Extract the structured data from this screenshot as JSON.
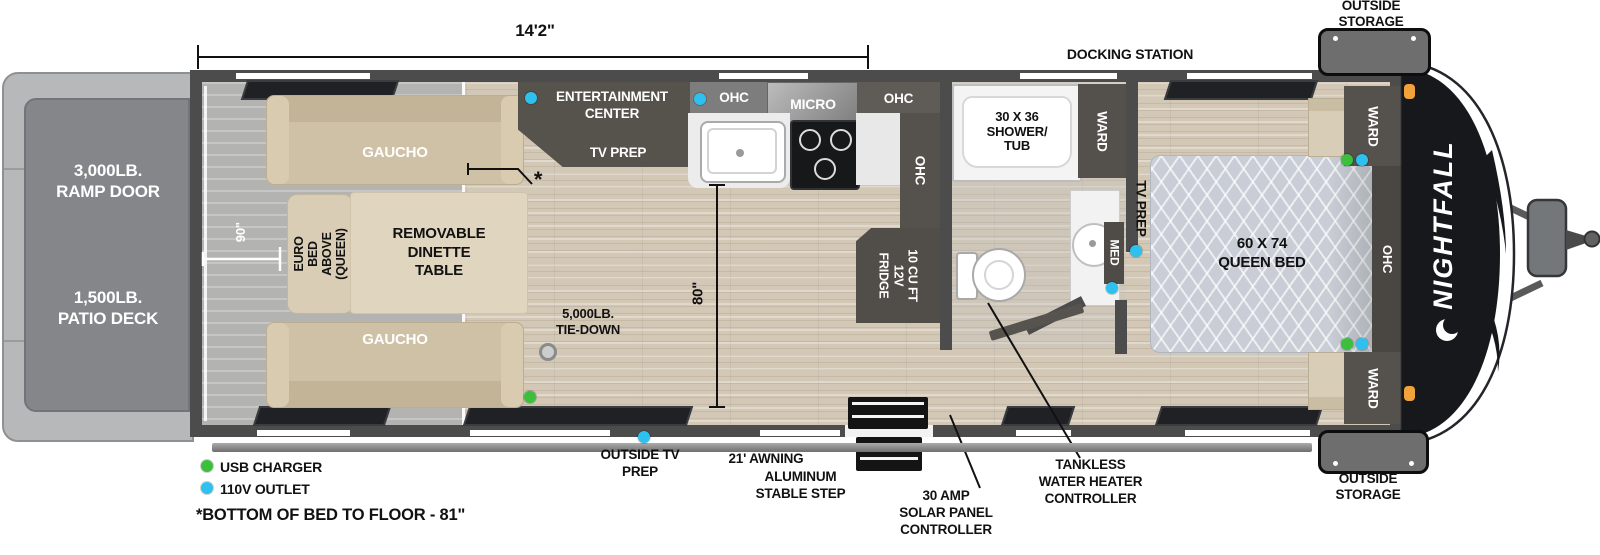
{
  "colors": {
    "accent_green": "#3cbf3c",
    "accent_blue": "#2ec1f0",
    "wall": "#4c4c4c",
    "wood_floor": "#d3c8b6",
    "cabinet_dark": "#55514c"
  },
  "dims": {
    "length": "14'2\"",
    "garage_width": "90\"",
    "kitchen_height": "80\"",
    "asterisk_mark": "*"
  },
  "exterior": {
    "brand": "NIGHTFALL",
    "docking_station": "DOCKING STATION",
    "outside_storage_top": "OUTSIDE\nSTORAGE",
    "outside_storage_bottom": "OUTSIDE\nSTORAGE",
    "outside_tv_prep": "OUTSIDE TV\nPREP",
    "awning": "21' AWNING",
    "step": "ALUMINUM\nSTABLE STEP",
    "solar": "30 AMP\nSOLAR PANEL\nCONTROLLER",
    "tankless": "TANKLESS\nWATER HEATER\nCONTROLLER",
    "ramp_door": "3,000LB.\nRAMP DOOR",
    "patio_deck": "1,500LB.\nPATIO DECK"
  },
  "garage": {
    "gaucho_top": "GAUCHO",
    "gaucho_bottom": "GAUCHO",
    "euro_bed": "EURO BED\nABOVE\n(QUEEN)",
    "dinette": "REMOVABLE\nDINETTE\nTABLE",
    "tie_down": "5,000LB.\nTIE-DOWN"
  },
  "kitchen": {
    "ent_center": "ENTERTAINMENT\nCENTER",
    "tv_prep": "TV PREP",
    "ohc_left": "OHC",
    "micro": "MICRO",
    "ohc_right": "OHC",
    "ohc_vert": "OHC",
    "fridge": "10 CU FT\n12V\nFRIDGE"
  },
  "bath": {
    "shower": "30 X 36\nSHOWER/\nTUB",
    "ward": "WARD",
    "med": "MED"
  },
  "bedroom": {
    "tv_prep": "TV PREP",
    "bed": "60 X 74\nQUEEN BED",
    "ward_top": "WARD",
    "ward_bottom": "WARD",
    "ohc": "OHC"
  },
  "legend": {
    "usb_label": "USB CHARGER",
    "outlet_label": "110V OUTLET",
    "usb_color": "#3cbf3c",
    "outlet_color": "#2ec1f0"
  },
  "footnote": "*BOTTOM OF BED TO FLOOR - 81\""
}
